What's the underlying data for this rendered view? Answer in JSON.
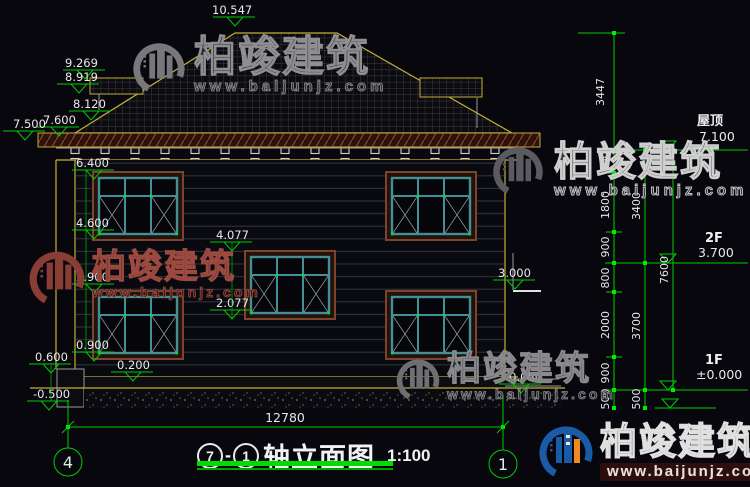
{
  "colors": {
    "background": "#07070d",
    "cad_green": "#00cc00",
    "cad_yellow": "#c4ae3a",
    "dim_text": "#e8e8e8",
    "watermark_red": "#9c4a40",
    "logo_blue": "#1a5ba6",
    "logo_orange": "#f08a1d"
  },
  "watermark": {
    "brand": "柏竣建筑",
    "site": "www.baijunjz.com"
  },
  "title_block": {
    "axis_from": "7",
    "dash": "-",
    "axis_to": "1",
    "name": "轴立面图",
    "scale": "1:100"
  },
  "axis_bubbles": {
    "left": "4",
    "right": "1"
  },
  "levels": {
    "ridge": "10.547",
    "left_wing_upper": "9.269",
    "left_wing_lower": "8.919",
    "left_wing_eave": "8.120",
    "eave_outer": "7.500",
    "eave_inner": "7.600",
    "wall_top": "6.400",
    "upper_window_sill": "4.600",
    "stair_window_head": "4.077",
    "floor_band": "2.900",
    "stair_window_sill": "2.077",
    "lower_window_sill": "0.900",
    "plinth_side": "0.600",
    "plinth_top": "0.200",
    "ground": "-0.500",
    "porch_head": "3.000",
    "porch_ground": "-0.050"
  },
  "story_levels": {
    "roof_label": "屋顶",
    "roof_value": "7.100",
    "f2_label": "2F",
    "f2_value": "3.700",
    "f1_label": "1F",
    "f1_value": "±0.000"
  },
  "dims": {
    "overall_width": "12780",
    "roof_rise": "3447",
    "inner": [
      "700",
      "1800",
      "900",
      "800",
      "2000",
      "900",
      "500"
    ],
    "mid": [
      "3400",
      "3700",
      "500"
    ],
    "outer": "7600"
  }
}
